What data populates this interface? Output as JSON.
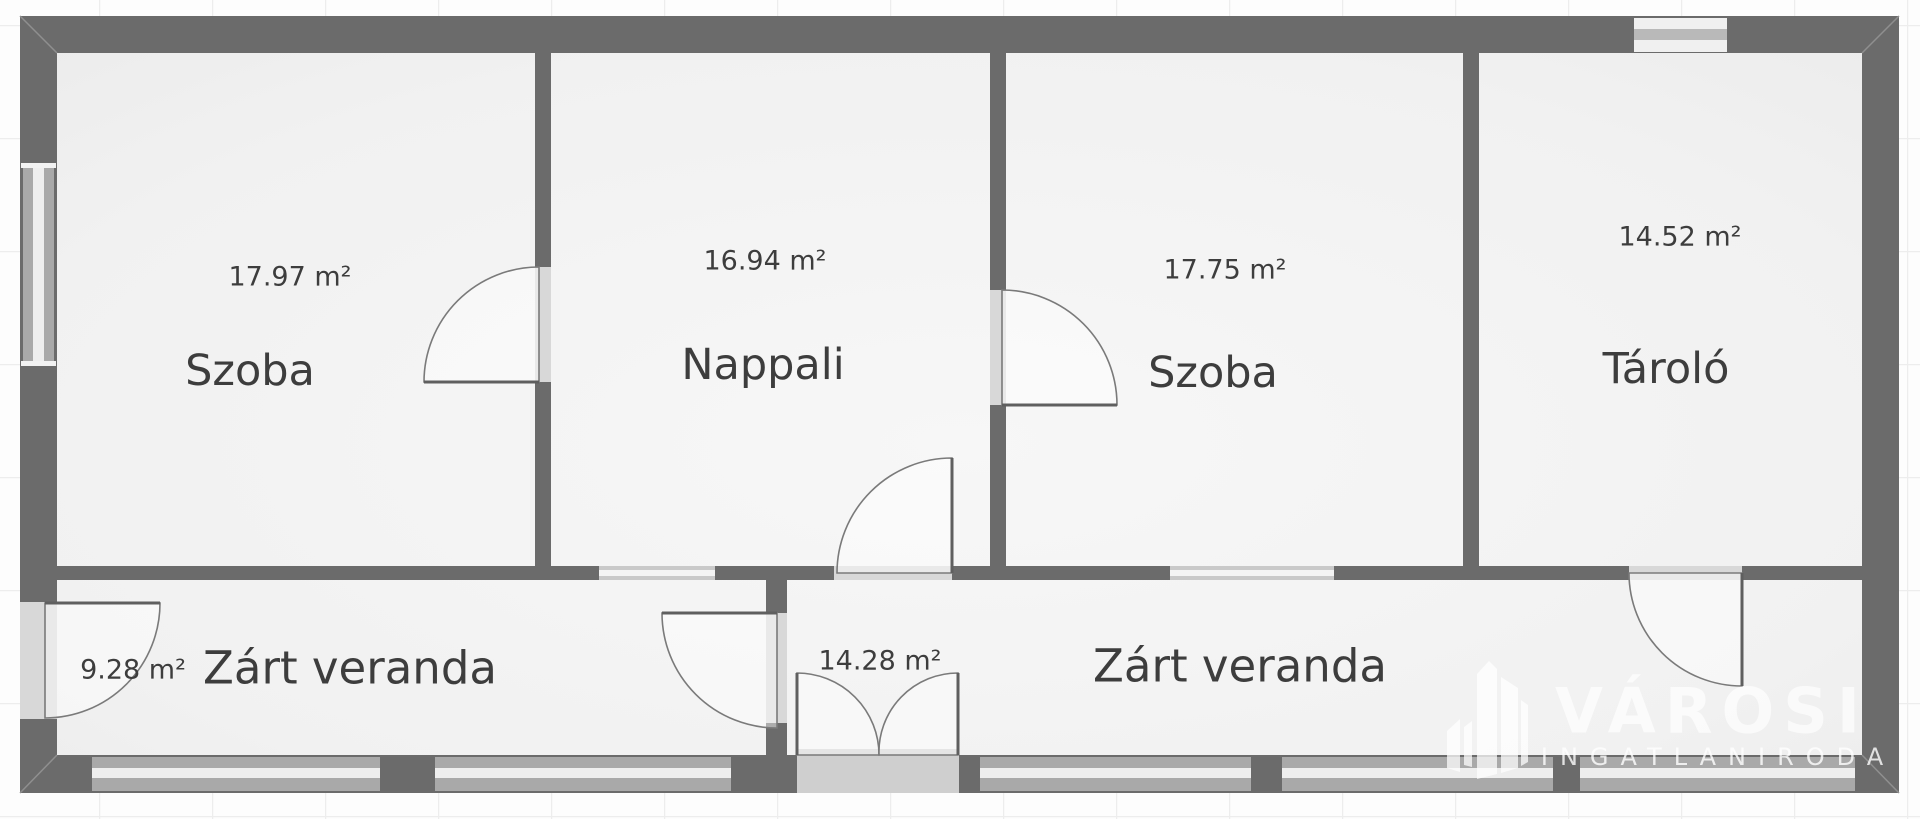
{
  "document": {
    "kind": "floor-plan",
    "language": "hu"
  },
  "palette": {
    "wall": "#6b6b6b",
    "room_fill_light": "#f7f7f7",
    "room_fill": "#eeeeee",
    "door_opening": "#d8d8d8",
    "double_door_opening": "#cfcfcf",
    "window_base": "#a9a9a9",
    "window_stripe": "#eeeeee",
    "inner_window_base": "#c9c9c9",
    "inner_window_stripe": "#f4f4f4",
    "door_leaf_line": "#5f5f5f",
    "door_arc_line": "#7a7a7a",
    "corner_seam": "#8f8f8f",
    "label_text": "#3d3d3d",
    "background": "#fdfdfd",
    "grid_line": "#ededed",
    "watermark_white": "#ffffff"
  },
  "rooms": [
    {
      "id": "szoba-1",
      "name": "Szoba",
      "area_label": "17.97 m²"
    },
    {
      "id": "nappali",
      "name": "Nappali",
      "area_label": "16.94 m²"
    },
    {
      "id": "szoba-2",
      "name": "Szoba",
      "area_label": "17.75 m²"
    },
    {
      "id": "tarolo",
      "name": "Tároló",
      "area_label": "14.52 m²"
    },
    {
      "id": "zart-veranda-left",
      "name": "Zárt veranda",
      "area_label": "9.28 m²"
    },
    {
      "id": "zart-veranda-right",
      "name": "Zárt veranda",
      "area_label": "14.28 m²"
    }
  ],
  "watermark": {
    "brand": "VÁROSI",
    "tagline": "INGATLANIRODA"
  }
}
